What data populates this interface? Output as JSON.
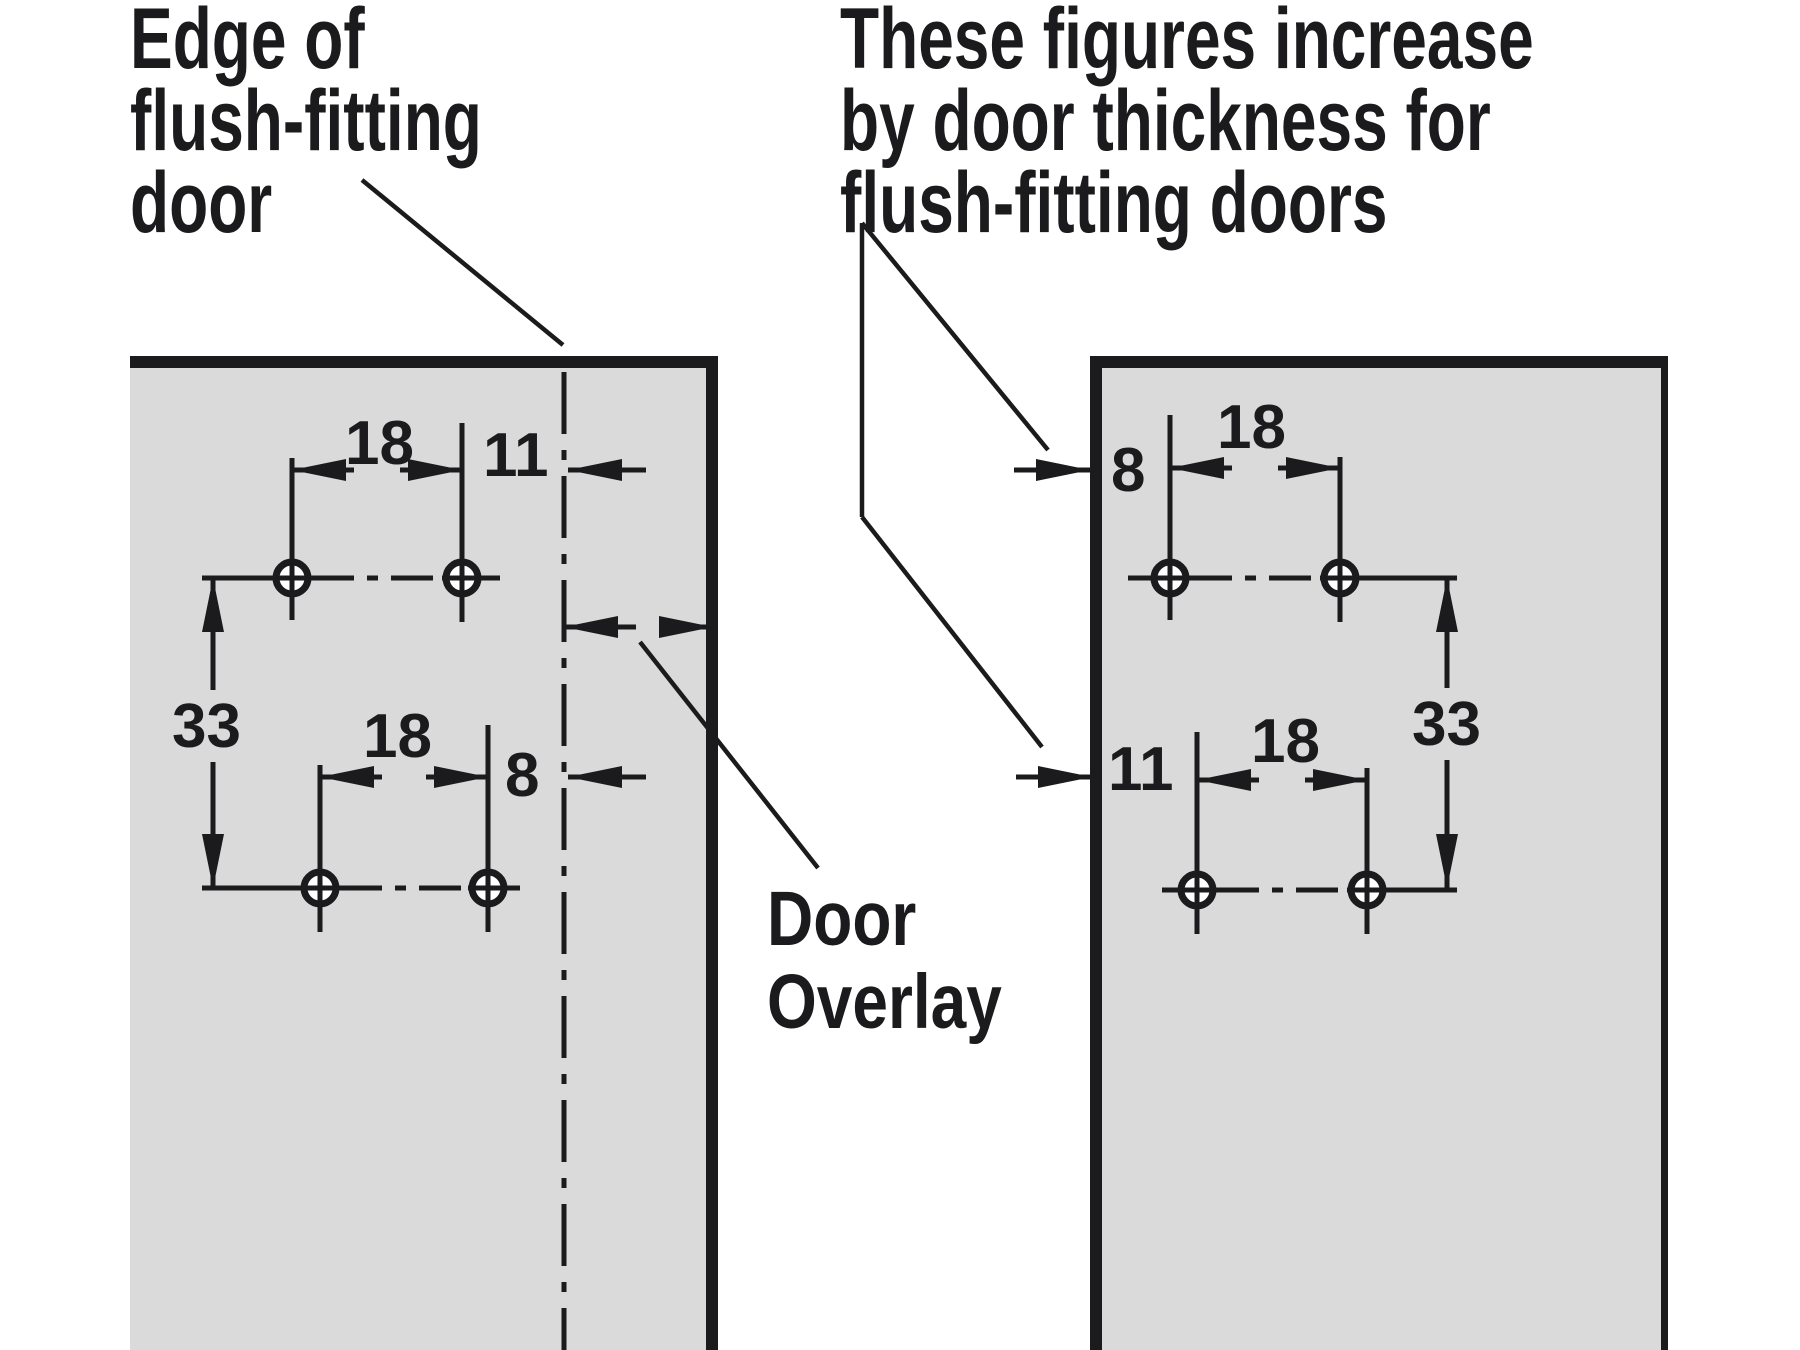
{
  "colors": {
    "ink": "#1b1b1d",
    "panel_fill": "#d9dad9",
    "background": "#ffffff"
  },
  "annotations": {
    "edge_label": {
      "line1": "Edge of",
      "line2": "flush-fitting",
      "line3": "door"
    },
    "thickness_note": {
      "line1": "These figures increase",
      "line2": "by door thickness for",
      "line3": "flush-fitting doors"
    },
    "door_overlay_label": {
      "line1": "Door",
      "line2": "Overlay"
    }
  },
  "left_panel": {
    "dims": {
      "hole_spacing_top": "18",
      "overlay_offset_top": "11",
      "row_spacing": "33",
      "hole_spacing_bottom": "18",
      "overlay_offset_bottom": "8"
    }
  },
  "right_panel": {
    "dims": {
      "edge_offset_top": "8",
      "hole_spacing_top": "18",
      "row_spacing": "33",
      "edge_offset_bottom": "11",
      "hole_spacing_bottom": "18"
    }
  }
}
